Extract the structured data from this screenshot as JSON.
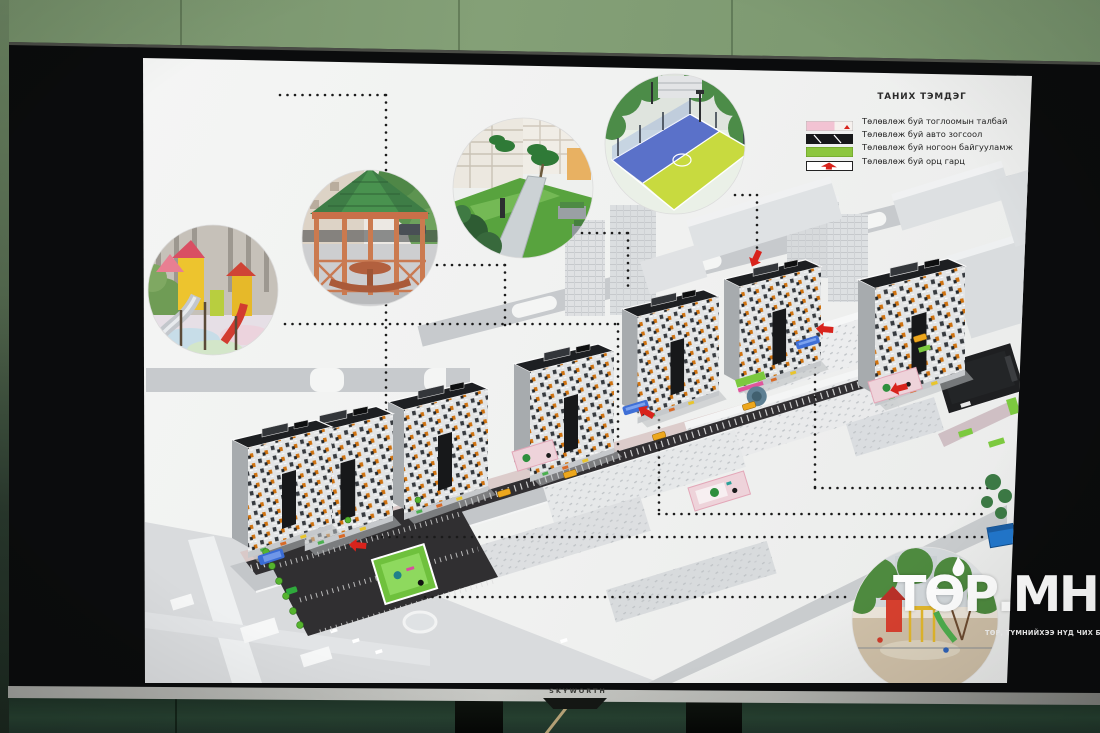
{
  "tv": {
    "brand": "SKYWORTH"
  },
  "slide": {
    "legend": {
      "title": "ТАНИХ ТЭМДЭГ",
      "items": [
        {
          "label": "Төлөвлөж буй тоглоомын талбай",
          "swatch": "pink-playground-swatch",
          "color": "#f2c3d3"
        },
        {
          "label": "Төлөвлөж буй авто зогсоол",
          "swatch": "black-hatched-swatch",
          "color": "#17181a"
        },
        {
          "label": "Төлөвлөж буй ногоон байгууламж",
          "swatch": "green-swatch",
          "color": "#8cc63e"
        },
        {
          "label": "Төлөвлөж буй орц гарц",
          "swatch": "white-entrance-arrow-swatch",
          "color": "#ffffff"
        }
      ]
    },
    "insets": [
      {
        "name": "playground-photo",
        "desc": "children playground with slides and tube"
      },
      {
        "name": "gazebo-photo",
        "desc": "wooden gazebo with green shingle roof"
      },
      {
        "name": "courtyard-path-photo",
        "desc": "green courtyard with walkway"
      },
      {
        "name": "sport-court-photo",
        "desc": "blue and yellow fenced sport court"
      },
      {
        "name": "existing-playground-photo",
        "desc": "existing yard playground"
      }
    ],
    "site_plan": {
      "type": "residential-complex-masterplan",
      "tower_count": 6,
      "colors": {
        "planned_green": "#6fc13d",
        "parking_asphalt": "#312f32",
        "entrance_arrow": "#d8231c",
        "playground_patch": "#eed3da",
        "facade_accent": "#cf720f"
      }
    }
  },
  "watermark": {
    "brand": "ТӨР.МН",
    "tagline": "ТӨР, ТҮМНИЙХЭЭ НҮД ЧИХ БОЛНО"
  }
}
